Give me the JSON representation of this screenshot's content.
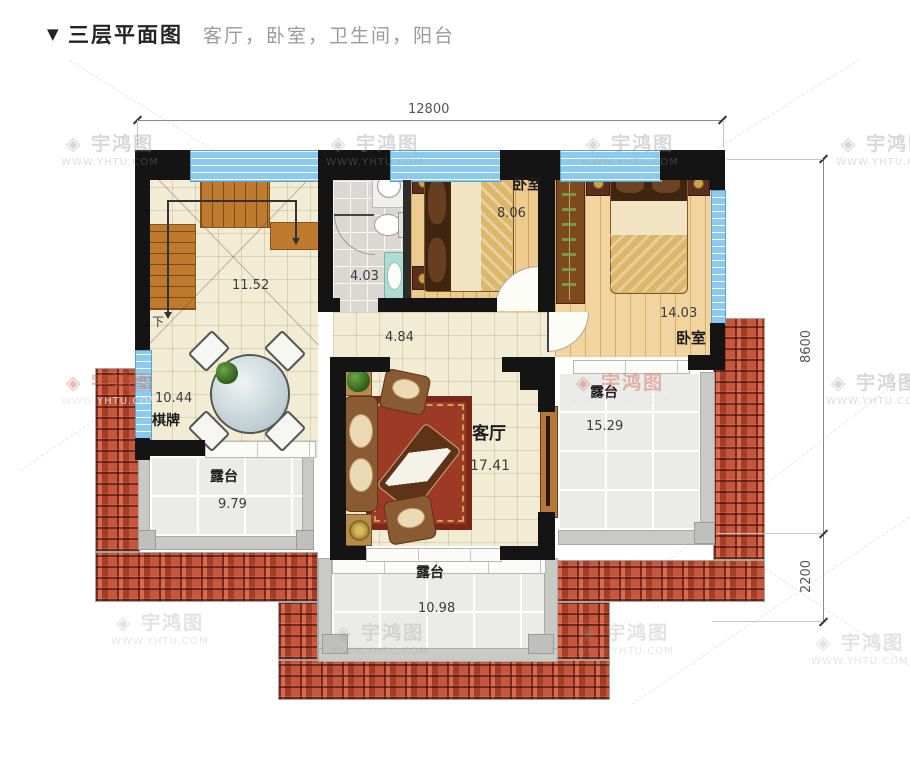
{
  "header": {
    "marker": "▼",
    "title": "三层平面图",
    "subtitle": "客厅，卧室，卫生间，阳台"
  },
  "dimensions": {
    "top_width": "12800",
    "right_upper": "8600",
    "right_lower": "2200"
  },
  "rooms": {
    "stairs": {
      "area": "11.52",
      "down_label": "下"
    },
    "bathroom": {
      "area": "4.03"
    },
    "bedroom1": {
      "name": "卧室",
      "area": "8.06"
    },
    "bedroom2": {
      "name": "卧室",
      "area": "14.03"
    },
    "hallway": {
      "area": "4.84"
    },
    "chess_room": {
      "name": "棋牌",
      "area": "10.44"
    },
    "living_room": {
      "name": "客厅",
      "area": "17.41"
    },
    "terrace_left": {
      "name": "露台",
      "area": "9.79"
    },
    "terrace_right": {
      "name": "露台",
      "area": "15.29"
    },
    "terrace_bottom": {
      "name": "露台",
      "area": "10.98"
    }
  },
  "watermark": {
    "logo_glyph": "◈",
    "brand": "宇鸿图",
    "url": "WWW.YHTU.COM"
  },
  "colors": {
    "wall": "#141414",
    "window_blue": "#8bcaec",
    "roof_red": "#b94c33",
    "floor_cream": "#f2ecd4",
    "floor_wood": "#edca8e",
    "terrace_gray": "#ebebe9"
  }
}
